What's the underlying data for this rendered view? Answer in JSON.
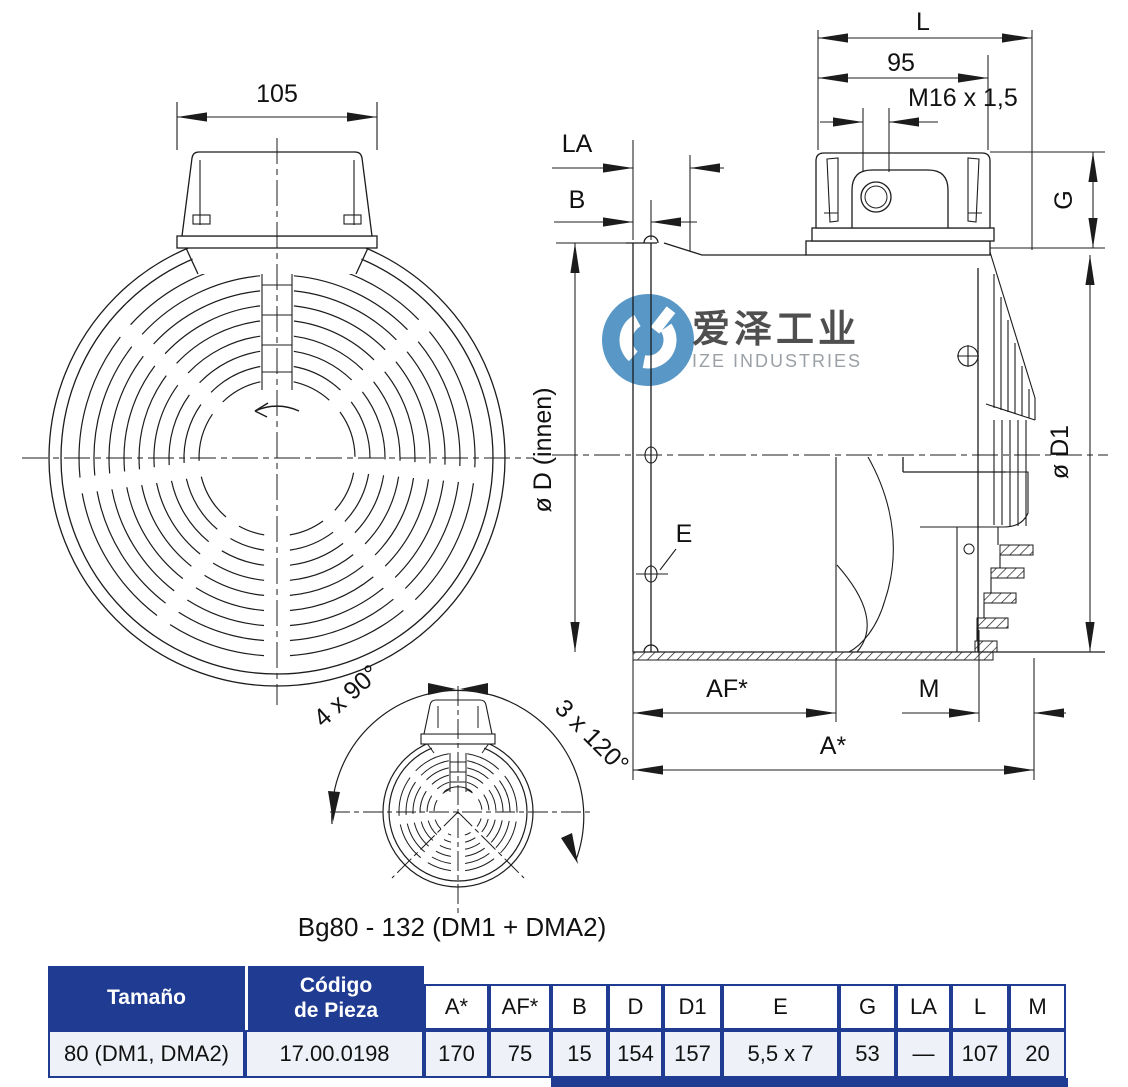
{
  "front_view": {
    "width_dim": "105"
  },
  "side_view": {
    "dim_L": "L",
    "dim_95": "95",
    "dim_m16": "M16 x 1,5",
    "dim_LA": "LA",
    "dim_B": "B",
    "dim_G": "G",
    "dim_d_innen": "ø D (innen)",
    "dim_d1": "ø D1",
    "dim_E": "E",
    "dim_AF": "AF*",
    "dim_M": "M",
    "dim_A": "A*"
  },
  "bottom_view": {
    "angle_left": "4 x 90°",
    "angle_right": "3 x 120°",
    "caption": "Bg80 - 132 (DM1 + DMA2)"
  },
  "watermark": {
    "cn": "爱泽工业",
    "en": "IZE INDUSTRIES",
    "logo_color": "#5897c6"
  },
  "table": {
    "header_bg": "#203c92",
    "row_bg": "#eef1f8",
    "header_size": "Tamaño",
    "header_code_line1": "Código",
    "header_code_line2": "de Pieza",
    "dim_headers": [
      "A*",
      "AF*",
      "B",
      "D",
      "D1",
      "E",
      "G",
      "LA",
      "L",
      "M"
    ],
    "row": {
      "size": "80 (DM1, DMA2)",
      "code": "17.00.0198",
      "values": [
        "170",
        "75",
        "15",
        "154",
        "157",
        "5,5 x 7",
        "53",
        "—",
        "107",
        "20"
      ]
    }
  }
}
